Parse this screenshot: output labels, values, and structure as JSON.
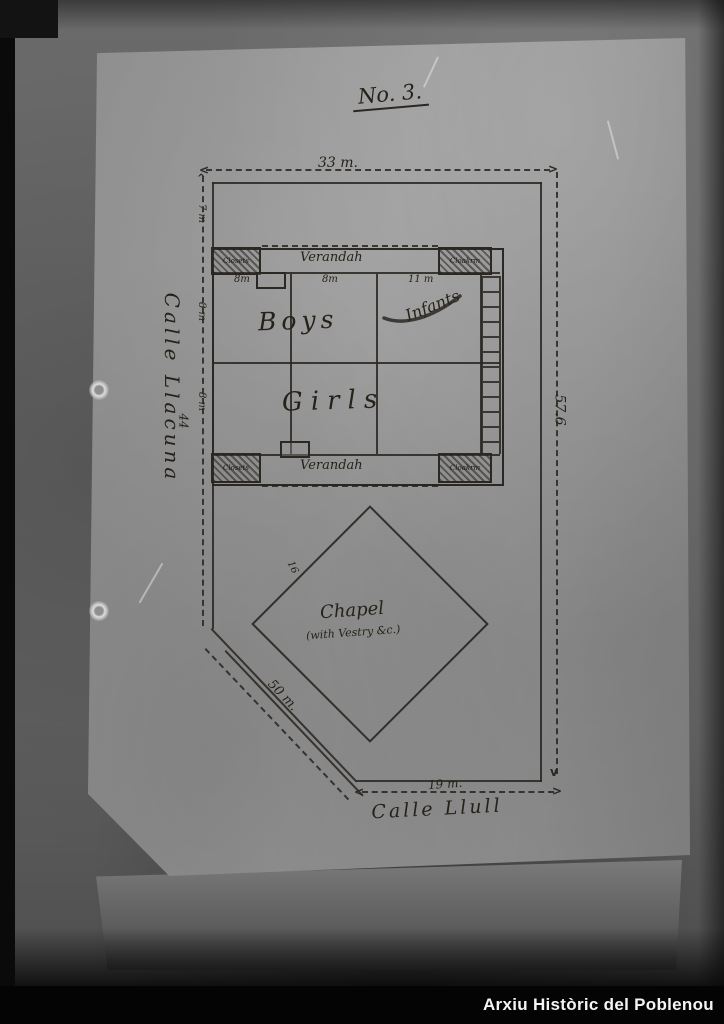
{
  "plan": {
    "title": "No. 3.",
    "streets": {
      "left": "Calle Llacuna",
      "bottom": "Calle Llull"
    },
    "dimensions": {
      "top": "33 m.",
      "right": "57.6",
      "bottom": "19 m.",
      "diagonal": "50 m.",
      "left_total": "44",
      "left_strip": "7 m",
      "row_upper": "8 m",
      "row_lower": "8 m",
      "col1": "8m",
      "col2": "8m",
      "col3": "11 m",
      "chapel_edge": "16"
    },
    "building": {
      "verandah": "Verandah",
      "closets": "Closets",
      "cloakroom": "Cloakrm",
      "rooms": {
        "boys": "Boys",
        "infants": "Infants",
        "girls": "Girls"
      }
    },
    "chapel": {
      "label": "Chapel",
      "note": "(with Vestry &c.)"
    }
  },
  "watermark": {
    "text": "Arxiu Històric del Poblenou"
  },
  "colors": {
    "ink": "#2b2722",
    "paper": "#949494",
    "watermark_bg": "#040404"
  }
}
